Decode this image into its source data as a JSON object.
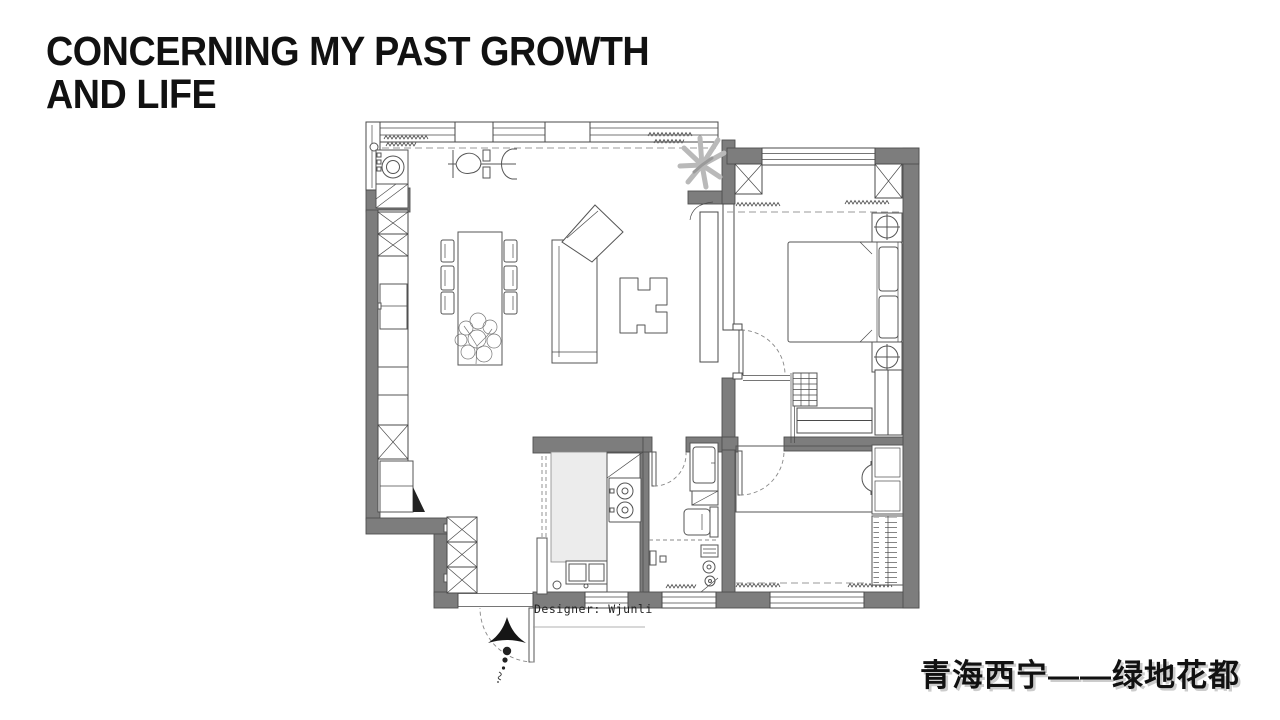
{
  "slide": {
    "title": {
      "line1": "CONCERNING MY PAST GROWTH",
      "line2": "AND LIFE"
    },
    "designer_note": "Designer: Wjunli",
    "location_caption": "青海西宁——绿地花都"
  },
  "floor_plan": {
    "type": "apartment-floor-plan",
    "symbols": [
      "north-arrow",
      "entry-door-swing",
      "washing-machine",
      "tall-cabinet-x",
      "shoe-cabinet",
      "fridge",
      "dining-table-six-chairs",
      "potted-tree",
      "corner-sofa",
      "puzzle-coffee-table",
      "tv-panel",
      "pendant-lamp",
      "decor-plant",
      "window-band",
      "curtain-zigzag",
      "double-bed",
      "pillows",
      "nightstand-lamp",
      "closet-grid",
      "wardrobe-hanging-rails",
      "gas-stove-two-burners",
      "kitchen-island",
      "double-sink",
      "sliding-door",
      "bathroom-vanity",
      "toilet",
      "shower-heads",
      "desk",
      "desk-chair",
      "mirror-wardrobe",
      "slatted-shelf",
      "door-swing-arc",
      "structural-column"
    ],
    "colors": {
      "background": "#ffffff",
      "wall_fill": "#7d7d7d",
      "wall_stroke": "#4f4f4f",
      "line": "#4a4a4a",
      "furniture_line": "#555555",
      "counter_fill": "#ececec",
      "plant_gray": "#b9b9b9",
      "dash": "#9a9a9a",
      "text": "#111111"
    }
  }
}
